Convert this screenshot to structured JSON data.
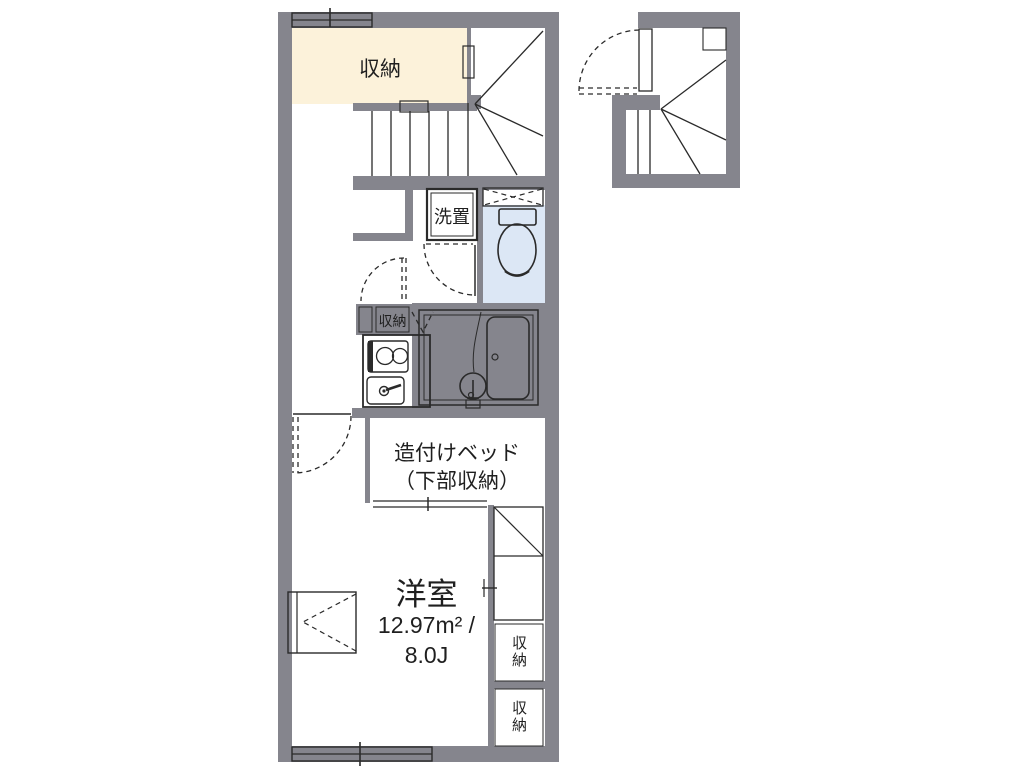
{
  "plan": {
    "type": "apartment-floor-plan",
    "colors": {
      "wall": "#85858d",
      "storage_fill": "#fcf2da",
      "wet_area_fill": "#dce7f5",
      "line": "#2a2a2a",
      "background": "#ffffff"
    },
    "rooms": {
      "storage_top": {
        "label": "収納"
      },
      "washer_space": {
        "label": "洗置"
      },
      "hall_closet": {
        "label": "収納"
      },
      "built_in_bed": {
        "label_line1": "造付けベッド",
        "label_line2": "（下部収納）"
      },
      "main_room": {
        "name": "洋室",
        "area_m2": "12.97m² /",
        "area_jo": "8.0J"
      },
      "closet_right_top": {
        "label": "収納"
      },
      "closet_right_bottom": {
        "label": "収納"
      }
    },
    "fixtures": [
      "storage-room",
      "staircase-winder",
      "staircase-straight",
      "washing-machine-space",
      "toilet",
      "ventilation-window",
      "hall-closet",
      "kitchen-counter",
      "two-burner-stove",
      "kitchen-sink",
      "unit-bath",
      "bathtub",
      "washbasin",
      "built-in-bed",
      "wall-cabinet",
      "refrigerator-space",
      "closet",
      "entrance-staircase",
      "entry-door",
      "window"
    ]
  }
}
